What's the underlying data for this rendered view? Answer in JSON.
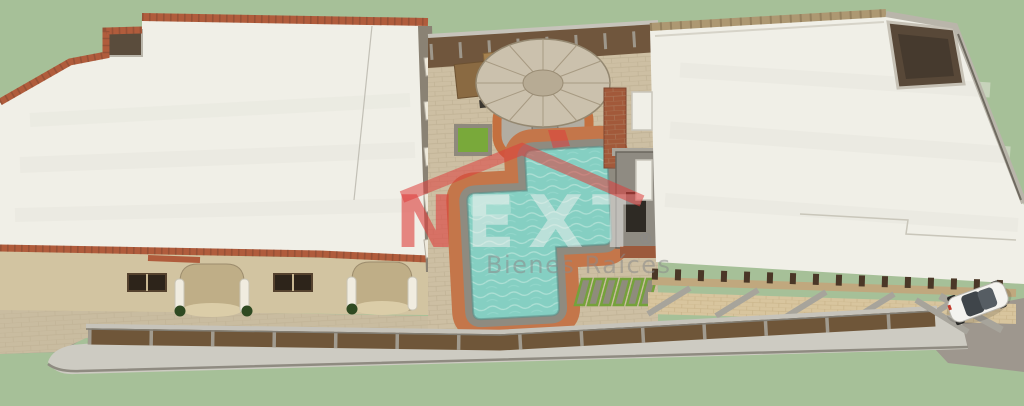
{
  "watermark": {
    "letters": [
      "N",
      "E",
      "X",
      "T"
    ],
    "registered": "®",
    "tagline": "Bienes Raíces"
  },
  "colors": {
    "grass": "#a6c098",
    "roof_white": "#f0efe7",
    "brick": "#b05c3c",
    "facade": "#d2c4a1",
    "pavers": "#cdbfa3",
    "pool_water": "#85cfc2",
    "pool_deck": "#c4764a",
    "coping": "#8f8b80",
    "thatch": "#cbc1ad",
    "fence_wood": "#6f5639",
    "sidewalk": "#cdcbc2",
    "driveway": "#9e978e",
    "planter": "#79a93a",
    "logo_red": "#de3e3c",
    "logo_gray": "#8a8a8a",
    "car": "#f4f3ef"
  }
}
